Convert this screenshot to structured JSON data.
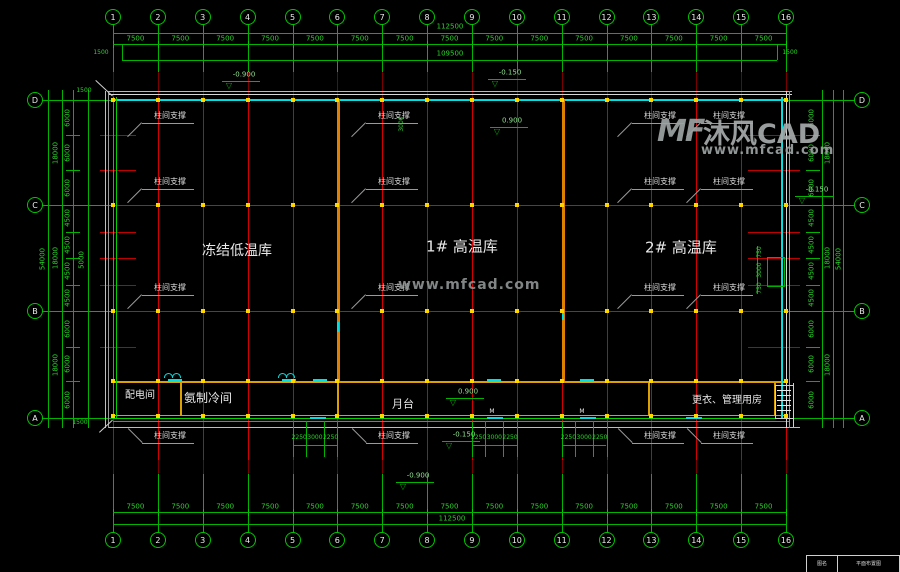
{
  "watermark": {
    "logo": "MF",
    "brand": "沐风CAD",
    "url": "www.mfcad.com"
  },
  "title_block": {
    "col1": "图名",
    "col2": "平面布置图"
  },
  "plan": {
    "grid_cols": {
      "xs": [
        113,
        157.9,
        202.7,
        247.6,
        292.5,
        337.3,
        382.2,
        427.1,
        471.9,
        516.8,
        561.7,
        606.5,
        651.4,
        696.3,
        741.1,
        786
      ],
      "labels": [
        "1",
        "2",
        "3",
        "4",
        "5",
        "6",
        "7",
        "8",
        "9",
        "10",
        "11",
        "12",
        "13",
        "14",
        "15",
        "16"
      ],
      "bubble_top_y": 17,
      "bubble_bottom_y": 540
    },
    "grid_rows": {
      "ys": [
        100,
        205,
        311,
        418
      ],
      "labels": [
        "D",
        "C",
        "B",
        "A"
      ],
      "bubble_left_x": 35,
      "bubble_right_x": 862
    },
    "sub_rows": [
      135,
      170,
      231.5,
      258,
      284.5,
      346.7
    ],
    "top_dims": {
      "bay": "7500",
      "total": "112500",
      "inner_total": "109500",
      "edge_left": "1500",
      "edge_right": "1500"
    },
    "bottom_dims": {
      "bay": "7500",
      "total": "112500"
    },
    "side_dims": {
      "boundaries": [
        100,
        135,
        170,
        205,
        231.5,
        258,
        284.5,
        311,
        346.7,
        381,
        418
      ],
      "segments": [
        "6000",
        "6000",
        "6000",
        "4500",
        "4500",
        "4500",
        "4500",
        "6000",
        "6000",
        "6000"
      ],
      "groups": [
        "18000",
        "18000",
        "18000"
      ],
      "group_mids": [
        152.5,
        258,
        364.5
      ],
      "total": "54000",
      "extra": "5000",
      "cap_top": "1500",
      "cap_bottom": "1500"
    },
    "rooms": [
      {
        "t": "冻结低温库",
        "x": 237,
        "y": 251,
        "s": 14
      },
      {
        "t": "1# 高温库",
        "x": 462,
        "y": 247,
        "s": 15
      },
      {
        "t": "2# 高温库",
        "x": 681,
        "y": 248,
        "s": 15
      },
      {
        "t": "配电间",
        "x": 140,
        "y": 396,
        "s": 10
      },
      {
        "t": "氨制冷间",
        "x": 208,
        "y": 398,
        "s": 12
      },
      {
        "t": "月台",
        "x": 403,
        "y": 404,
        "s": 11
      },
      {
        "t": "更衣、管理用房",
        "x": 727,
        "y": 401,
        "s": 10
      }
    ],
    "bracing": {
      "label": "柱间支撑",
      "points": [
        [
          170,
          116
        ],
        [
          394,
          116
        ],
        [
          660,
          116
        ],
        [
          729,
          116
        ],
        [
          170,
          182
        ],
        [
          394,
          182
        ],
        [
          660,
          182
        ],
        [
          729,
          182
        ],
        [
          170,
          288
        ],
        [
          394,
          288
        ],
        [
          660,
          288
        ],
        [
          729,
          288
        ],
        [
          170,
          436
        ],
        [
          394,
          436
        ],
        [
          660,
          436
        ],
        [
          729,
          436
        ]
      ]
    },
    "elev_markers": [
      {
        "t": "-0.900",
        "x": 222,
        "y": 81
      },
      {
        "t": "-0.150",
        "x": 488,
        "y": 79
      },
      {
        "t": "0.900",
        "x": 490,
        "y": 127
      },
      {
        "t": "-0.150",
        "x": 795,
        "y": 196
      },
      {
        "t": "0.900",
        "x": 446,
        "y": 398
      },
      {
        "t": "-0.150",
        "x": 442,
        "y": 441
      },
      {
        "t": "-0.900",
        "x": 396,
        "y": 482
      }
    ],
    "door_dims": {
      "values": [
        "2250",
        "3000",
        "2250"
      ],
      "bays": [
        [
          292.5,
          337.3
        ],
        [
          471.9,
          516.8
        ],
        [
          561.7,
          606.5
        ]
      ]
    },
    "pit_dims": {
      "labels": [
        "750",
        "3000",
        "750"
      ],
      "ys": [
        252,
        270,
        288
      ],
      "x": 760
    },
    "extra_vtexts": [
      {
        "t": "3000",
        "x": 402,
        "y": 124
      }
    ],
    "door_tags": [
      {
        "t": "M",
        "x": 492,
        "y": 412
      },
      {
        "t": "M",
        "x": 582,
        "y": 412
      }
    ],
    "door_dashes_wall": [
      168,
      282,
      313,
      487,
      580
    ],
    "door_dashes_platform": [
      310,
      487,
      580,
      686
    ],
    "door_arcs": [
      [
        164,
        373
      ],
      [
        278,
        373
      ]
    ],
    "annex_partitions": [
      180,
      337,
      648,
      774
    ],
    "colors": {
      "grid_green": "#00b400",
      "bright_green": "#00d000",
      "dim_text": "#29d429",
      "red": "#d40000",
      "dark_red": "#7a0000",
      "cyan": "#00e0e0",
      "yellow": "#dca100",
      "orange": "#e08000",
      "white_line": "#d8d8d8",
      "gray_line": "#9a9a9a",
      "label_white": "#e8e8e8",
      "elev_green": "#8fe08f"
    }
  }
}
